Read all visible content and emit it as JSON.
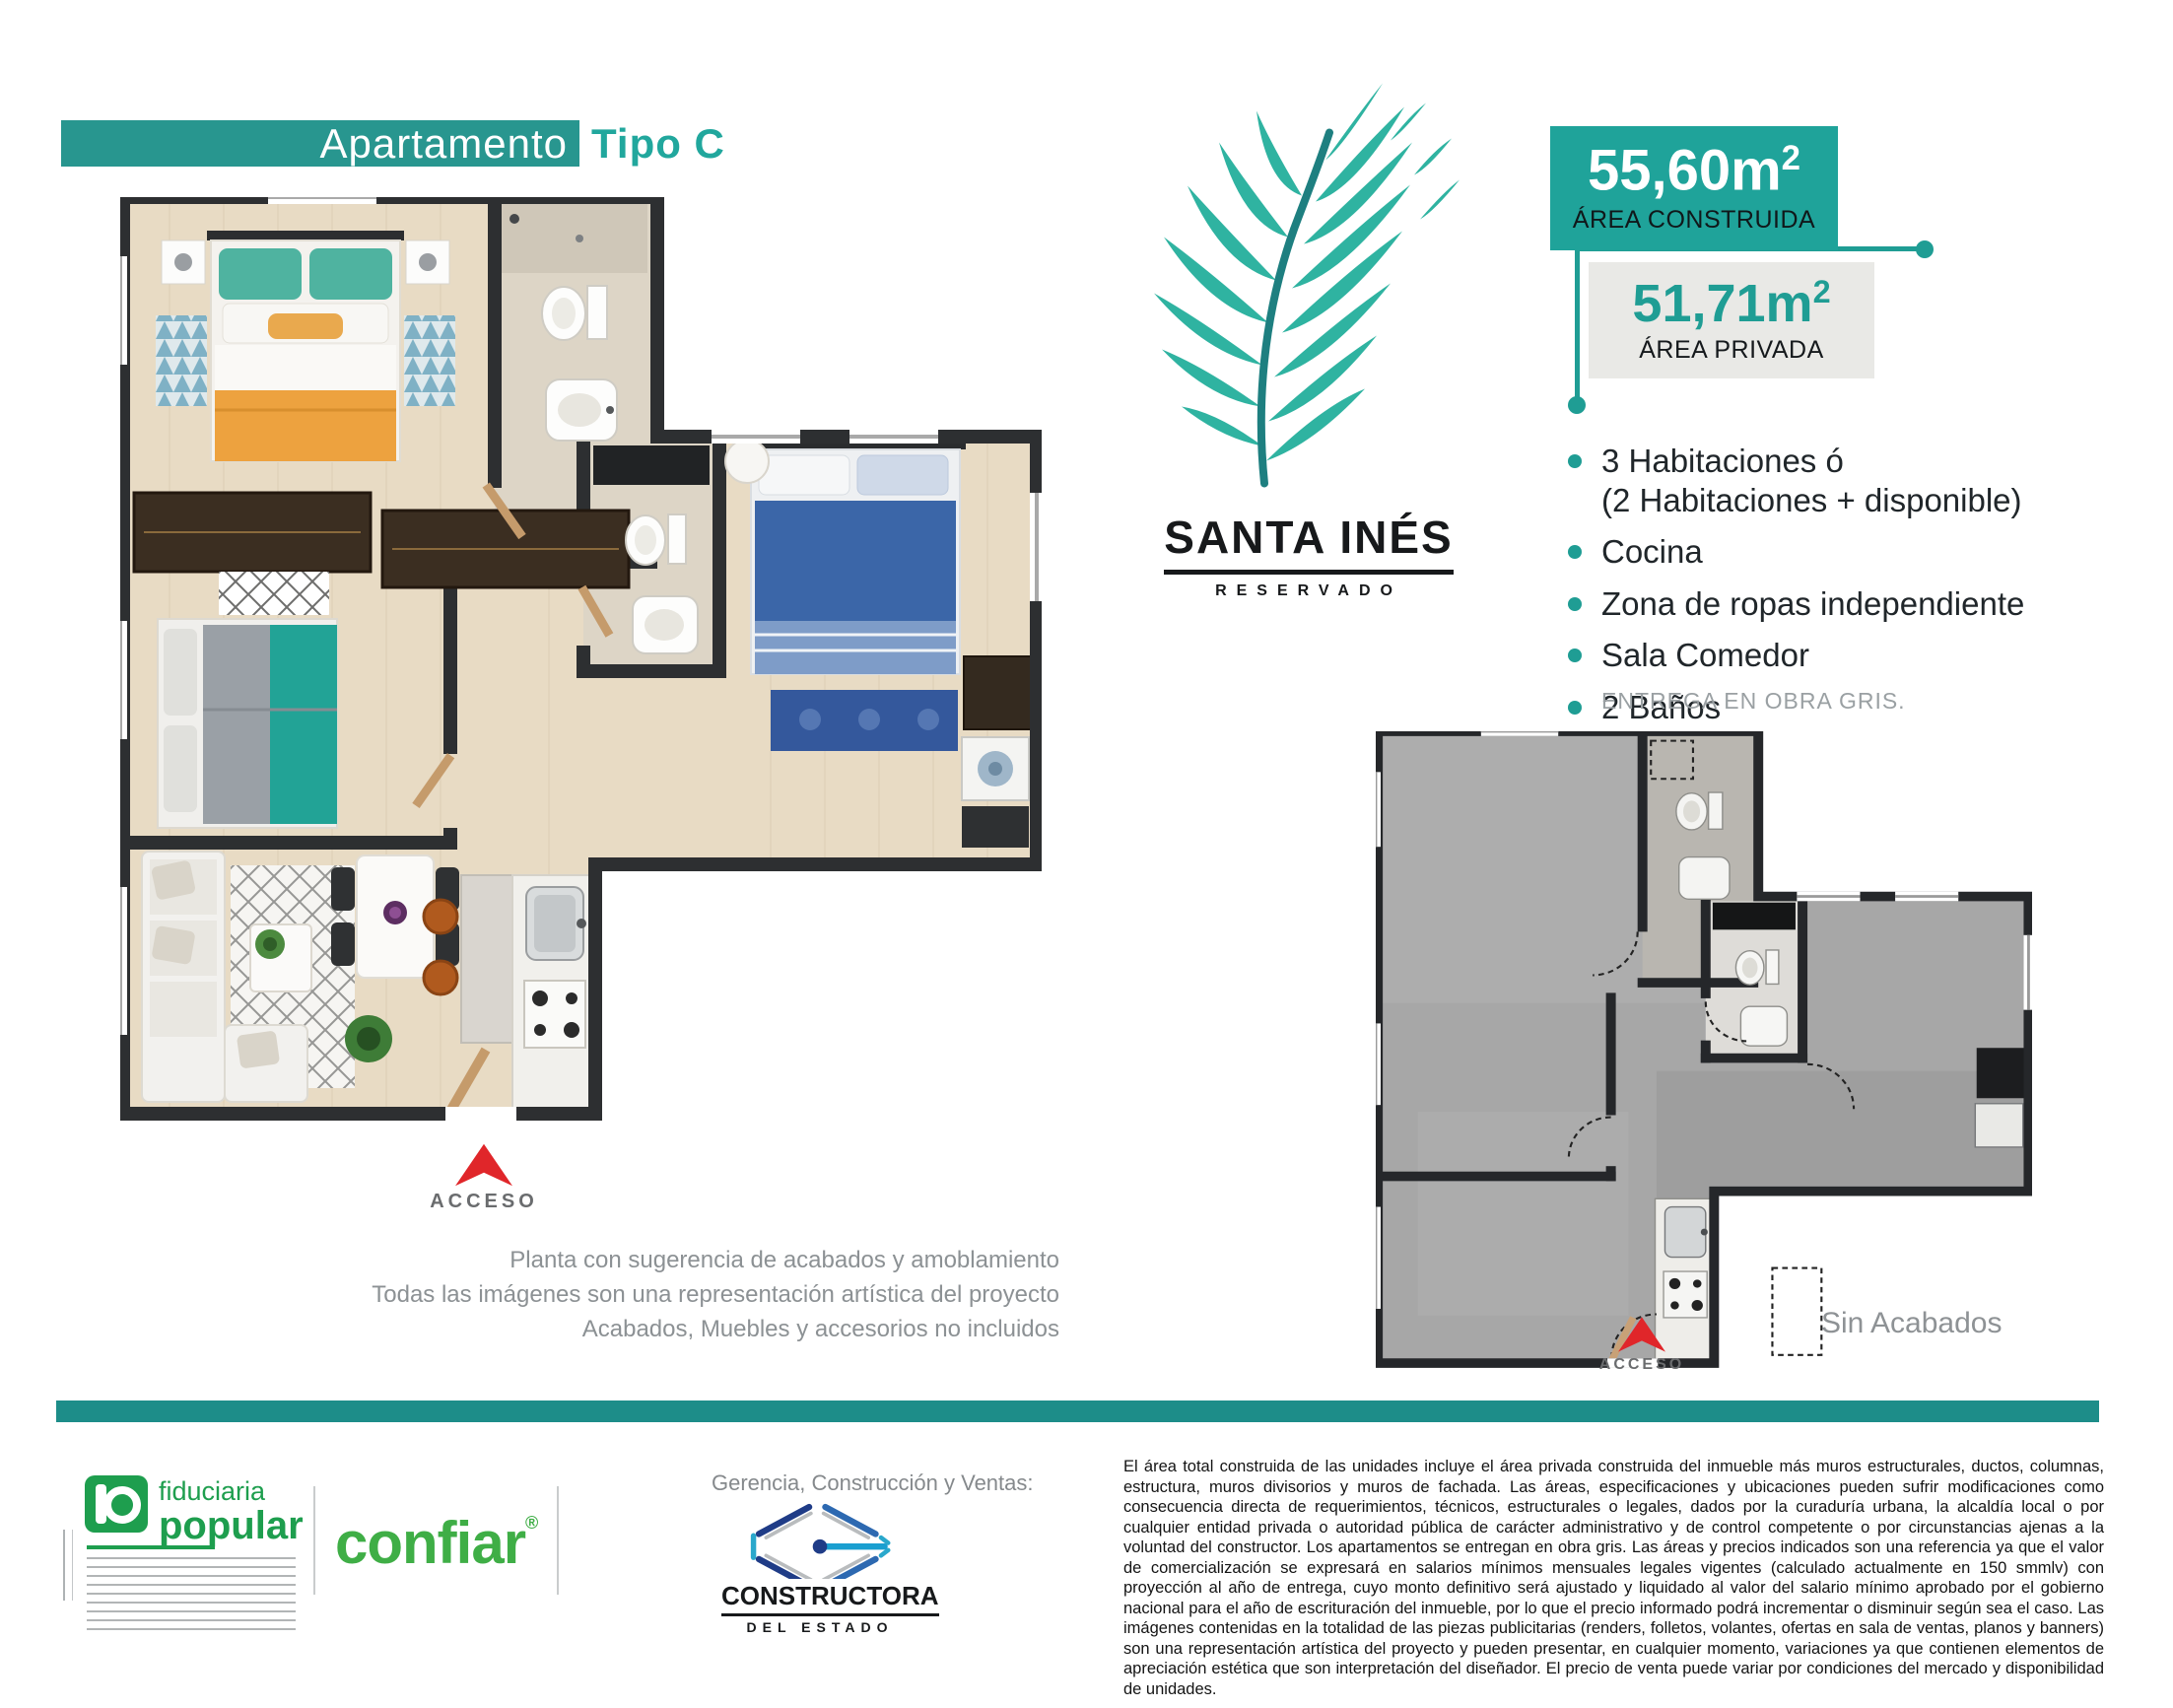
{
  "header": {
    "title": "Apartamento",
    "subtitle": "Tipo C"
  },
  "project": {
    "name": "SANTA INÉS",
    "tagline": "RESERVADO"
  },
  "areas": {
    "built": {
      "value": "55,60m",
      "sup": "2",
      "label": "ÁREA CONSTRUIDA"
    },
    "private": {
      "value": "51,71m",
      "sup": "2",
      "label": "ÁREA PRIVADA"
    }
  },
  "features": {
    "items": [
      "3 Habitaciones ó\n(2 Habitaciones + disponible)",
      "Cocina",
      "Zona de ropas independiente",
      "Sala Comedor",
      "2 Baños"
    ],
    "delivery_note": "ENTREGA EN OBRA GRIS."
  },
  "furnished_plan": {
    "access_label": "ACCESO",
    "access_icon": "red-up-arrow",
    "caption_lines": [
      "Planta con sugerencia de acabados y amoblamiento",
      "Todas las imágenes son una representación artística del proyecto",
      "Acabados, Muebles y accesorios no incluidos"
    ]
  },
  "unfinished_plan": {
    "access_label": "ACCESO",
    "access_icon": "red-up-arrow",
    "caption": "Sin Acabados"
  },
  "footer": {
    "fiduciaria": {
      "word1": "fiduciaria",
      "word2": "popular"
    },
    "confiar": {
      "word": "confiar",
      "mark": "®"
    },
    "management_label": "Gerencia, Construcción y Ventas:",
    "constructora": {
      "word1": "CONSTRUCTORA",
      "word2": "DEL ESTADO"
    },
    "legal": "El área total construida de las unidades incluye el área privada construida del inmueble más muros estructurales, ductos, columnas, estructura, muros divisorios y muros de fachada. Las áreas, especificaciones y ubicaciones pueden sufrir modificaciones como consecuencia directa de requerimientos, técnicos, estructurales o legales, dados por la curaduría urbana, la alcaldía local o por cualquier entidad privada o autoridad pública de carácter administrativo y de control competente o por circunstancias ajenas a la voluntad del constructor. Los apartamentos se entregan en obra gris. Las áreas y precios indicados son una referencia ya que el valor de comercialización se expresará en salarios mínimos mensuales legales vigentes (calculado actualmente en 150 smmlv) con proyección al año de entrega, cuyo monto definitivo será ajustado y liquidado al valor del salario mínimo aprobado por el gobierno nacional para el año de escrituración del inmueble, por lo que el precio informado podrá incrementar o disminuir según sea el caso. Las imágenes contenidas en la totalidad de las piezas publicitarias (renders, folletos, volantes, ofertas en sala de ventas, planos y banners) son una representación artística del proyecto y pueden presentar, en cualquier momento, variaciones ya que contienen elementos de apreciación estética que son interpretación del diseñador. El precio de venta puede variar por condiciones del mercado y disponibilidad de unidades."
  },
  "colors": {
    "teal_header": "#28968f",
    "teal_badge": "#1fa39a",
    "teal_bar": "#1d8d89",
    "accent_red": "#e0262a",
    "popular_green": "#1e9e4e",
    "confiar_green": "#3fae46",
    "ce_navy": "#1f3c87",
    "ce_blue": "#2d69b1",
    "ce_lightblue": "#2aa8cc"
  }
}
